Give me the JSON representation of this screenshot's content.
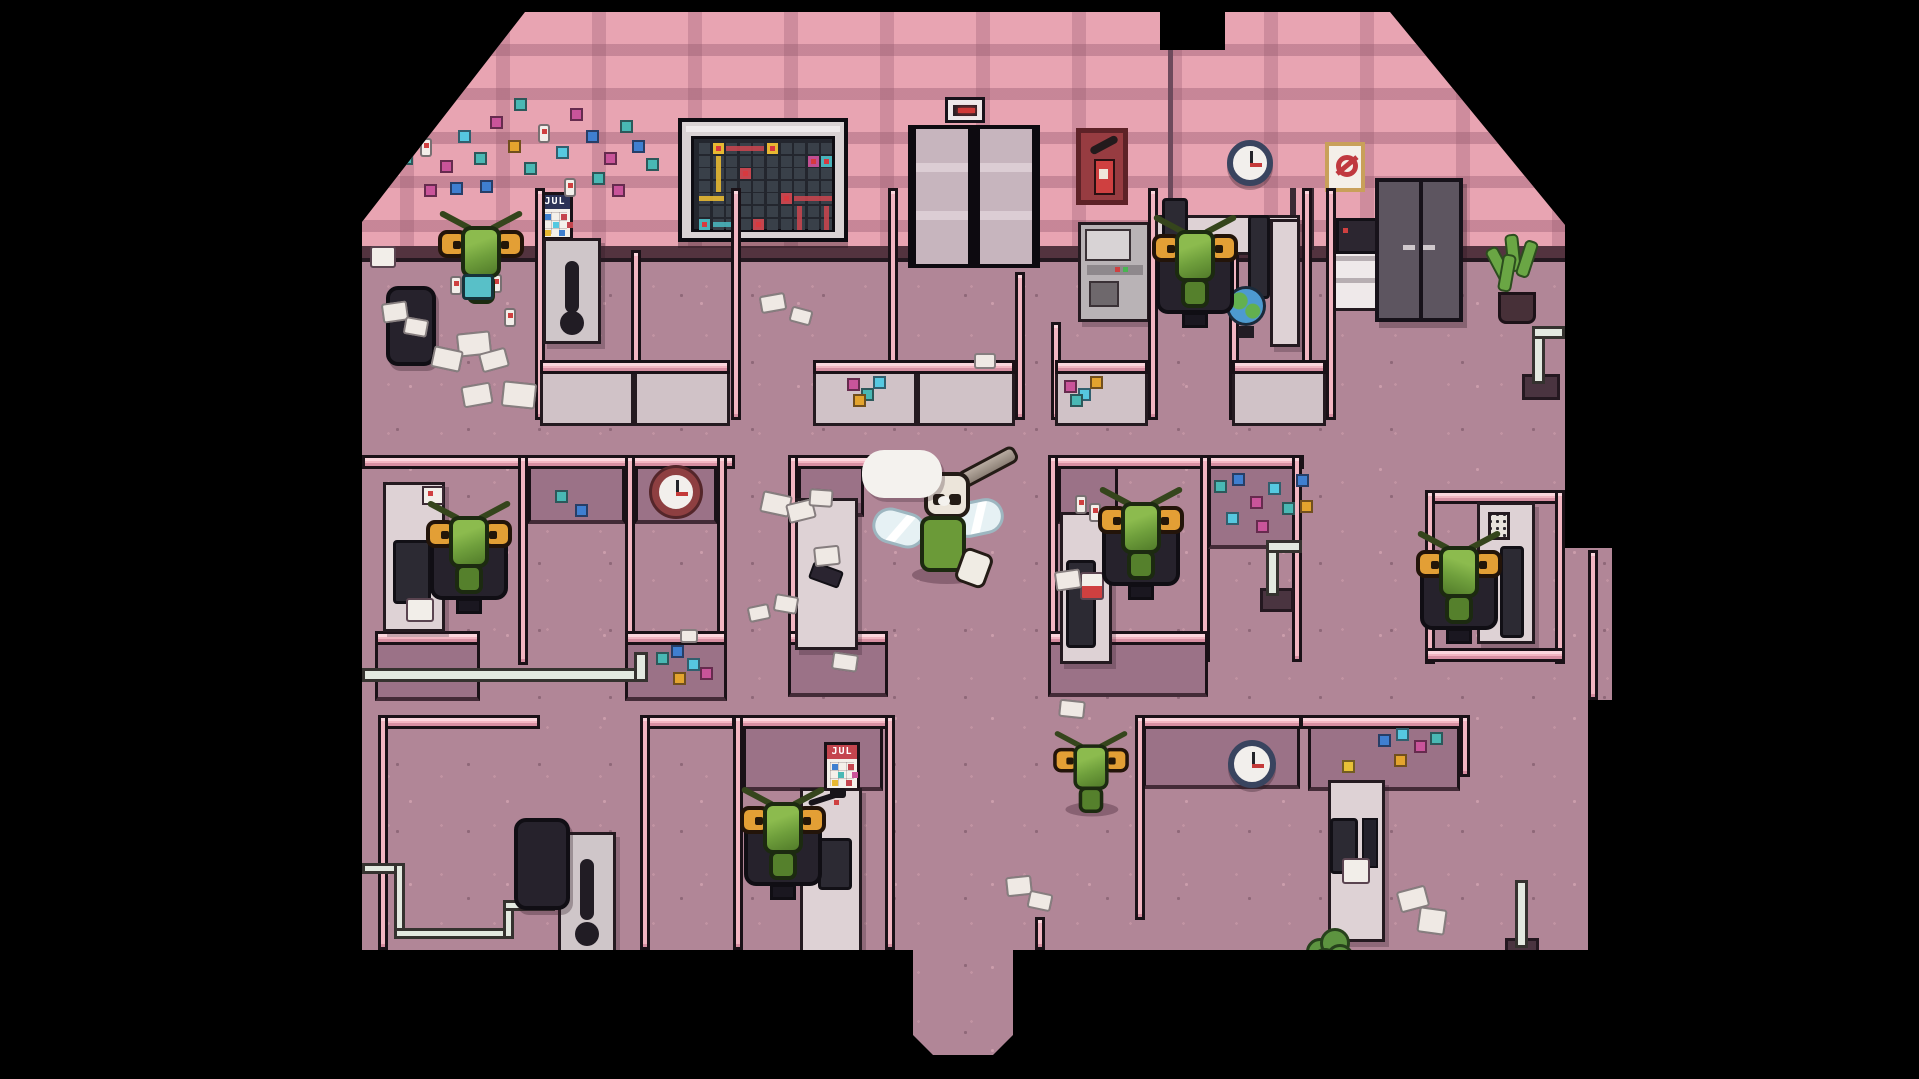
{
  "scene": {
    "title": "pixel-office-floor",
    "style": "top-down pixel art office with fly workers"
  },
  "palette": {
    "background": "#000000",
    "wall_pink": "#e8a4b2",
    "wall_pattern": "#c1879b",
    "floor": "#b18697",
    "cubicle_cap": "#f2b6c2",
    "cubicle_face": "#9b7287",
    "desk": "#ded2d5",
    "fly_green": "#6f9f3c",
    "eye_orange": "#e39f35",
    "accent_red": "#c4454e",
    "accent_yellow": "#e7b832",
    "accent_teal": "#49b2ba",
    "notes": {
      "T": "#49b8b4",
      "M": "#c9549a",
      "O": "#e3a42e",
      "B": "#3f7fd0",
      "C": "#56c8e0",
      "Y": "#e7c137",
      "W": "#f2eee9"
    }
  },
  "calendars": {
    "top": {
      "label": "JUL",
      "header_color": "#2c3357",
      "squares": [
        [
          2,
          2,
          "#3f7fd0"
        ],
        [
          18,
          2,
          "#c4454e"
        ],
        [
          10,
          10,
          "#56c8e0"
        ],
        [
          24,
          10,
          "#c4454e"
        ],
        [
          2,
          18,
          "#e7b832"
        ],
        [
          16,
          18,
          "#3f7fd0"
        ]
      ]
    },
    "bottom": {
      "label": "JUL",
      "header_color": "#c4454e",
      "squares": [
        [
          2,
          2,
          "#3f7fd0"
        ],
        [
          18,
          2,
          "#c4454e"
        ],
        [
          8,
          10,
          "#49b8b4"
        ],
        [
          22,
          10,
          "#c9549a"
        ],
        [
          2,
          18,
          "#e7b832"
        ],
        [
          16,
          18,
          "#c4454e"
        ]
      ]
    }
  },
  "board": {
    "cols": 10,
    "rows": 7,
    "cell": {
      "w": 13.6,
      "h": 12.6,
      "size": 11,
      "ox": 5,
      "oy": 4
    },
    "colors": {
      "Y": "#e7b832",
      "R": "#c4454e",
      "T": "#49b2ba",
      "M": "#c04f93",
      "base": "#394049",
      "dot": "#d8393f"
    },
    "items": [
      {
        "t": "cell",
        "r": 0,
        "c": 1,
        "k": "Y",
        "dot": true
      },
      {
        "t": "cell",
        "r": 0,
        "c": 5,
        "k": "Y",
        "dot": true
      },
      {
        "t": "v",
        "r": 1,
        "c": 1,
        "len": 3,
        "k": "Y"
      },
      {
        "t": "h",
        "r": 4,
        "c": 0,
        "len": 2,
        "k": "Y"
      },
      {
        "t": "h",
        "r": 0,
        "c": 2,
        "len": 3,
        "k": "R"
      },
      {
        "t": "cell",
        "r": 1,
        "c": 8,
        "k": "M",
        "dot": true
      },
      {
        "t": "cell",
        "r": 1,
        "c": 9,
        "k": "T",
        "dot": true
      },
      {
        "t": "cell",
        "r": 2,
        "c": 3,
        "k": "R",
        "dot": true
      },
      {
        "t": "cell",
        "r": 4,
        "c": 6,
        "k": "R",
        "dot": true
      },
      {
        "t": "h",
        "r": 4,
        "c": 7,
        "len": 3,
        "k": "R"
      },
      {
        "t": "v",
        "r": 5,
        "c": 7,
        "len": 2,
        "k": "R"
      },
      {
        "t": "v",
        "r": 5,
        "c": 9,
        "len": 2,
        "k": "R"
      },
      {
        "t": "cell",
        "r": 6,
        "c": 0,
        "k": "T",
        "dot": true
      },
      {
        "t": "h",
        "r": 6,
        "c": 1,
        "len": 2,
        "k": "T"
      },
      {
        "t": "cell",
        "r": 6,
        "c": 4,
        "k": "R",
        "dot": true
      }
    ]
  },
  "clocks": [
    {
      "id": "wall-clock-top",
      "frame": "#39445f",
      "time": "3:00"
    },
    {
      "id": "wall-clock-mid",
      "frame": "#8e3f41",
      "time": "3:00"
    },
    {
      "id": "wall-clock-bottom",
      "frame": "#39445f",
      "time": "3:00"
    }
  ],
  "scatter": {
    "notes_top_left": [
      [
        38,
        140,
        "T"
      ],
      [
        58,
        126,
        "W"
      ],
      [
        78,
        148,
        "M"
      ],
      [
        96,
        118,
        "C"
      ],
      [
        112,
        140,
        "T"
      ],
      [
        128,
        104,
        "M"
      ],
      [
        146,
        128,
        "O"
      ],
      [
        162,
        150,
        "T"
      ],
      [
        88,
        170,
        "B"
      ],
      [
        118,
        168,
        "B"
      ],
      [
        176,
        112,
        "W"
      ],
      [
        194,
        134,
        "C"
      ],
      [
        208,
        96,
        "M"
      ],
      [
        224,
        118,
        "B"
      ],
      [
        242,
        140,
        "M"
      ],
      [
        152,
        86,
        "T"
      ],
      [
        258,
        108,
        "T"
      ],
      [
        62,
        172,
        "M"
      ],
      [
        34,
        98,
        "W"
      ],
      [
        202,
        166,
        "W"
      ],
      [
        230,
        160,
        "T"
      ],
      [
        250,
        172,
        "M"
      ],
      [
        270,
        128,
        "B"
      ],
      [
        284,
        146,
        "T"
      ]
    ],
    "notes_left_face": [
      [
        193,
        478,
        "T"
      ],
      [
        213,
        492,
        "B"
      ]
    ],
    "notes_pipe": [
      [
        309,
        633,
        "B"
      ],
      [
        325,
        646,
        "C"
      ],
      [
        311,
        660,
        "O"
      ],
      [
        338,
        655,
        "M"
      ],
      [
        294,
        640,
        "T"
      ]
    ],
    "notes_u2": [
      [
        485,
        366,
        "M"
      ],
      [
        499,
        376,
        "T"
      ],
      [
        511,
        364,
        "C"
      ],
      [
        491,
        382,
        "O"
      ]
    ],
    "notes_u3": [
      [
        702,
        368,
        "M"
      ],
      [
        716,
        376,
        "C"
      ],
      [
        728,
        364,
        "O"
      ],
      [
        708,
        382,
        "T"
      ]
    ],
    "notes_midright_face": [
      [
        852,
        468,
        "T"
      ],
      [
        870,
        461,
        "B"
      ],
      [
        888,
        484,
        "M"
      ],
      [
        906,
        470,
        "C"
      ],
      [
        920,
        490,
        "T"
      ],
      [
        934,
        462,
        "B"
      ],
      [
        894,
        508,
        "M"
      ],
      [
        864,
        500,
        "C"
      ],
      [
        938,
        488,
        "O"
      ]
    ],
    "notes_bottomright_face": [
      [
        1016,
        722,
        "B"
      ],
      [
        1034,
        716,
        "C"
      ],
      [
        1052,
        728,
        "M"
      ],
      [
        1068,
        720,
        "T"
      ],
      [
        1032,
        742,
        "O"
      ],
      [
        980,
        748,
        "Y"
      ]
    ],
    "bottles_floor": [
      [
        108,
        246,
        "W"
      ],
      [
        128,
        262,
        "W"
      ],
      [
        88,
        264,
        "W"
      ],
      [
        142,
        296,
        "W"
      ],
      [
        713,
        483,
        "W"
      ],
      [
        727,
        491,
        "W"
      ]
    ],
    "papers": [
      [
        398,
        282,
        26,
        18,
        -10
      ],
      [
        428,
        296,
        22,
        16,
        15
      ],
      [
        612,
        341,
        22,
        16,
        0
      ],
      [
        399,
        481,
        30,
        22,
        12
      ],
      [
        425,
        489,
        28,
        20,
        -14
      ],
      [
        447,
        477,
        24,
        18,
        4
      ],
      [
        452,
        534,
        26,
        20,
        -6
      ],
      [
        412,
        583,
        24,
        18,
        10
      ],
      [
        386,
        593,
        22,
        16,
        -12
      ],
      [
        318,
        617,
        18,
        14,
        0
      ],
      [
        470,
        641,
        26,
        18,
        8
      ],
      [
        693,
        558,
        26,
        20,
        -8
      ],
      [
        697,
        688,
        26,
        18,
        6
      ],
      [
        644,
        864,
        26,
        20,
        -6
      ],
      [
        666,
        880,
        24,
        18,
        12
      ],
      [
        1036,
        876,
        30,
        22,
        -15
      ],
      [
        1056,
        896,
        28,
        26,
        8
      ],
      [
        20,
        290,
        26,
        20,
        -8
      ],
      [
        42,
        306,
        24,
        18,
        10
      ],
      [
        95,
        320,
        34,
        24,
        -6
      ],
      [
        70,
        336,
        30,
        22,
        12
      ],
      [
        118,
        338,
        28,
        20,
        -15
      ],
      [
        140,
        370,
        34,
        26,
        6
      ],
      [
        100,
        372,
        30,
        22,
        -10
      ],
      [
        788,
        546,
        16,
        12,
        0
      ]
    ]
  },
  "characters": {
    "workers": "8 green fly office workers",
    "boss": "skull-masked fly with horn and wings, speech bubble (empty)"
  }
}
